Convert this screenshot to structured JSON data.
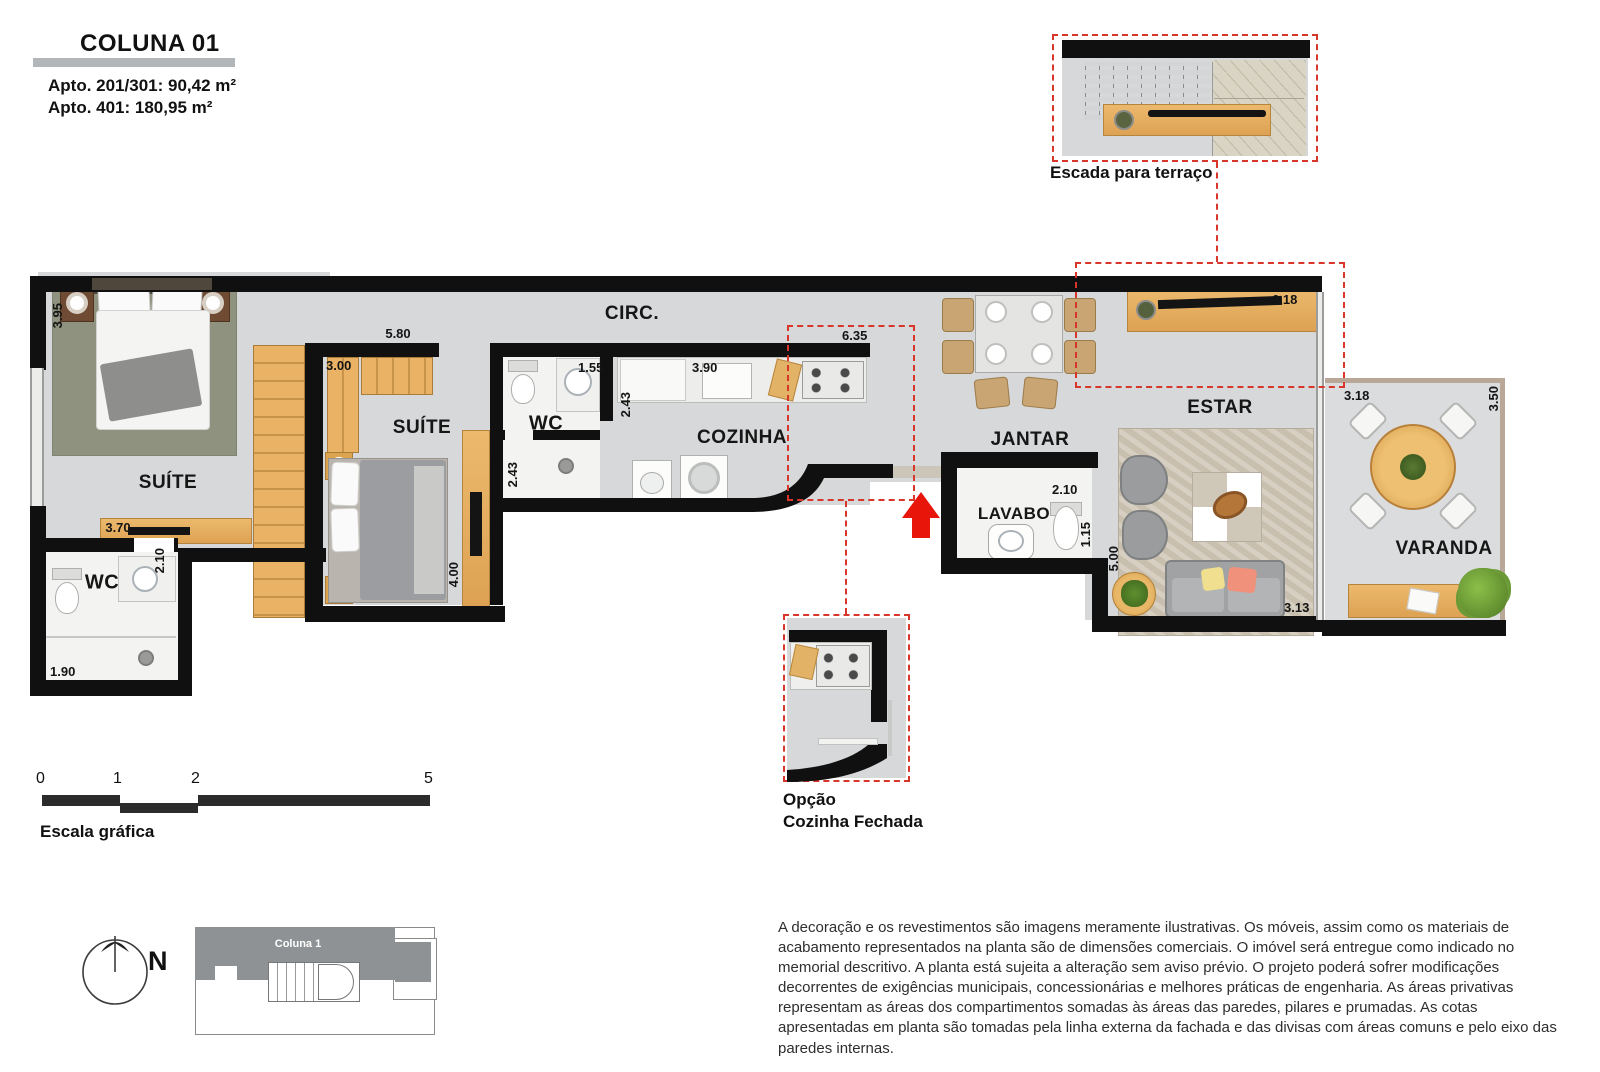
{
  "header": {
    "title": "COLUNA 01",
    "apto1": "Apto. 201/301: 90,42 m²",
    "apto2": "Apto. 401: 180,95 m²"
  },
  "insets": {
    "escada_label": "Escada para terraço",
    "opcao_line1": "Opção",
    "opcao_line2": "Cozinha Fechada"
  },
  "rooms": {
    "suite1": "SUÍTE",
    "suite2": "SUÍTE",
    "wc1": "WC",
    "wc2": "WC",
    "circ": "CIRC.",
    "cozinha": "COZINHA",
    "jantar": "JANTAR",
    "lavabo": "LAVABO",
    "estar": "ESTAR",
    "varanda": "VARANDA"
  },
  "dims": {
    "suite1_width": "3.95",
    "suite1_sideboard": "3.70",
    "wc1_depth": "2.10",
    "wc1_width": "1.90",
    "suite2_width": "5.80",
    "suite2_closet": "3.00",
    "suite2_desk": "4.00",
    "wc2_width": "1.55",
    "wc2_depth": "2.43",
    "cozinha_depth": "2.43",
    "cozinha_counter": "3.90",
    "cozinha_width": "6.35",
    "lavabo_width": "2.10",
    "lavabo_depth": "1.15",
    "estar_depth": "5.00",
    "estar_width": "3.13",
    "estar_wall": "6.18",
    "varanda_width": "3.18",
    "varanda_depth": "3.50"
  },
  "scale_bar": {
    "label": "Escala gráfica",
    "ticks": [
      "0",
      "1",
      "2",
      "5"
    ]
  },
  "compass": {
    "label": "N"
  },
  "key_plan": {
    "label": "Coluna 1"
  },
  "disclaimer": "A decoração e os revestimentos são imagens meramente ilustrativas. Os móveis, assim como os materiais de acabamento representados na planta são de dimensões comerciais. O imóvel será entregue como indicado no memorial descritivo. A planta está sujeita a alteração sem aviso prévio. O projeto poderá sofrer modificações decorrentes de exigências municipais, concessionárias e melhores práticas de engenharia. As áreas privativas representam as áreas dos compartimentos somadas às áreas das paredes, pilares e prumadas. As cotas apresentadas em planta são tomadas pela linha externa da fachada e das divisas com áreas comuns e pelo eixo das paredes internas.",
  "colors": {
    "accent_red": "#d8352b",
    "wall_black": "#101010",
    "wood": "#e2ae5f",
    "floor_gray": "#d6d8d9",
    "rug_green": "#8e927f",
    "rug_beige": "#c8bfae"
  }
}
